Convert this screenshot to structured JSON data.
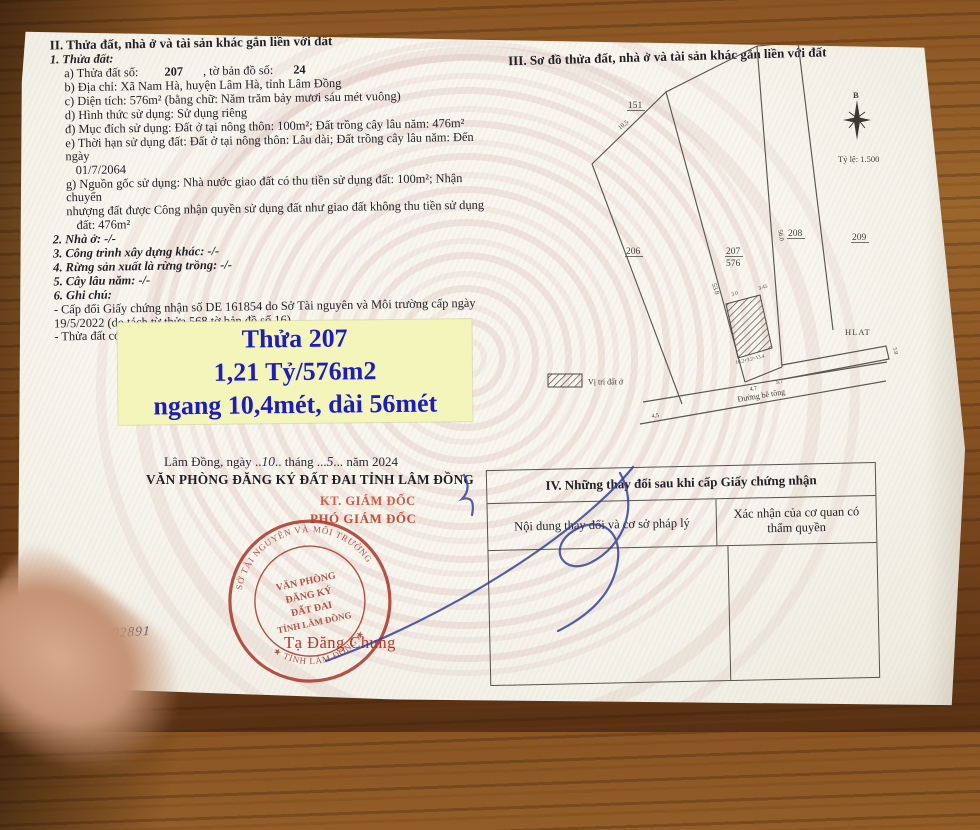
{
  "colors": {
    "accent_blue": "#1b1cc4",
    "box_yellow": "#f3f5ba",
    "stamp_red": "#b13a2e",
    "title_red": "#cf4a36",
    "signature_blue": "#2e3b9b"
  },
  "section2": {
    "title": "II. Thửa đất, nhà ở và tài sản khác gắn liền với đất",
    "sub1_title": "1. Thửa đất:",
    "item_a_l1": "a) Thửa đất số:",
    "item_a_v1": "207",
    "item_a_l2": ", tờ bản đồ số:",
    "item_a_v2": "24",
    "item_b": "b) Địa chỉ: Xã Nam Hà, huyện Lâm Hà, tỉnh Lâm Đồng",
    "item_c": "c) Diện tích: 576m² (bằng chữ: Năm trăm bảy mươi sáu mét vuông)",
    "item_d": "d) Hình thức sử dụng: Sử dụng riêng",
    "item_dd": "đ) Mục đích sử dụng: Đất ở tại nông thôn: 100m²; Đất trồng cây lâu năm: 476m²",
    "item_e_1": "e) Thời hạn sử dụng đất: Đất ở tại nông thôn: Lâu dài; Đất trồng cây lâu năm: Đến ngày",
    "item_e_2": "01/7/2064",
    "item_g_1": "g) Nguồn gốc sử dụng: Nhà nước giao đất có thu tiền sử dụng đất: 100m²; Nhận chuyển",
    "item_g_2": "nhượng đất được Công nhận quyền sử dụng đất như giao đất không thu tiền sử dụng",
    "item_g_3": "đất: 476m²",
    "item_2": "2. Nhà ở: -/-",
    "item_3": "3. Công trình xây dựng khác: -/-",
    "item_4": "4. Rừng sản xuất là rừng trồng: -/-",
    "item_5": "5. Cây lâu năm: -/-",
    "item_6": "6. Ghi chú:",
    "note_1a": "- Cấp đổi Giấy chứng nhận số DE 161854 do Sở Tài nguyên và Môi trường cấp ngày",
    "note_1b": "19/5/2022 (do tách từ thửa 568 tờ bản đồ số 16).",
    "note_2": "- Thửa đất có 52m² (CLN) thuộc hành lang an toàn đường bộ."
  },
  "price_box": {
    "line1": "Thửa 207",
    "line2": "1,21 Tỷ/576m2",
    "line3": "ngang 10,4mét, dài 56mét"
  },
  "section3": {
    "title": "III. Sơ đồ thửa đất, nhà ở và tài sản khác gắn liền với đất",
    "compass_north": "B",
    "scale": "Tỷ lệ: 1.500",
    "parcel_151": "151",
    "parcel_206": "206",
    "parcel_207": "207",
    "parcel_207_area": "576",
    "parcel_208": "208",
    "parcel_209": "209",
    "m_top": "10.5",
    "m_left": "53.8",
    "m_right": "56.0",
    "m_hatch1": "3.0",
    "m_hatch2": "3.45",
    "m_hatch3": "10.2+3.2=13.4",
    "m_b1": "4.7",
    "m_b2": "5.7",
    "m_road": "4.5",
    "m_hlat": "5.0",
    "road_label": "Đường bê tông",
    "hlat_label": "HLAT",
    "legend": "Vị trí đất ở"
  },
  "section4": {
    "title": "IV. Những thay đổi sau khi cấp Giấy chứng nhận",
    "col1": "Nội dung thay đổi và cơ sở pháp lý",
    "col2": "Xác nhận của cơ quan có thẩm quyền"
  },
  "footer": {
    "date_p1": "Lâm Đồng, ngày ..",
    "date_day": "10",
    "date_p2": ".. tháng ...",
    "date_month": "5",
    "date_p3": "... năm 2024",
    "office": "VĂN PHÒNG ĐĂNG KÝ ĐẤT ĐAI TỈNH LÂM ĐỒNG",
    "kt": "KT. GIÁM ĐỐC",
    "deputy": "PHÓ GIÁM ĐỐC",
    "signer": "Tạ Đăng Chung",
    "gcn_label": "ồ cấp GCN: VP",
    "gcn_number": "02891",
    "stamp_ring_top": "SỞ TÀI NGUYÊN VÀ MÔI TRƯỜNG",
    "stamp_ring_bottom": "★ TỈNH LÂM ĐỒNG ★",
    "stamp_center1": "VĂN PHÒNG",
    "stamp_center2": "ĐĂNG KÝ",
    "stamp_center3": "ĐẤT ĐAI",
    "stamp_center4": "TỈNH LÂM ĐỒNG"
  }
}
